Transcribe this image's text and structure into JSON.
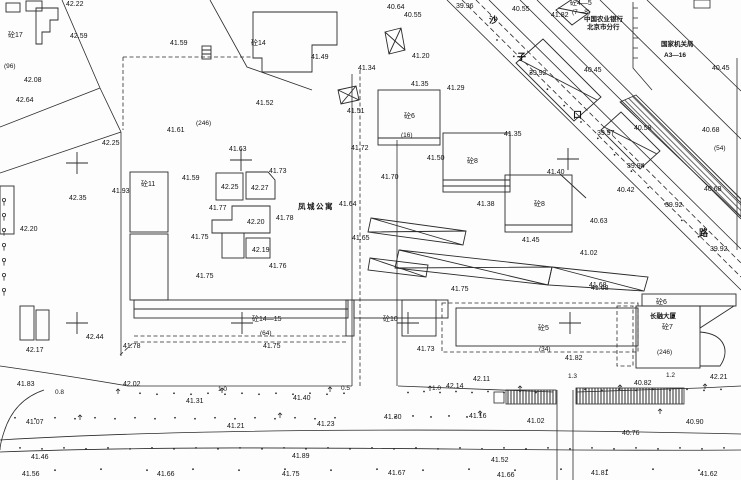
{
  "drawing": {
    "type": "topographic-site-plan",
    "street_name_chars": [
      "沙",
      "子",
      "口",
      "路"
    ],
    "place_names": {
      "apartment": "凤城公寓",
      "tower": "长融大厦",
      "bank_line1": "中国农业银行",
      "bank_line2": "北京市分行",
      "agency_line1": "国家机关局",
      "agency_line2": "A3—16"
    },
    "line_color": "#2b2b2b",
    "background": "#fdfdfd"
  },
  "labels": [
    {
      "t": "42.22",
      "x": 66,
      "y": 1,
      "k": "e"
    },
    {
      "t": "砼17",
      "x": 8,
      "y": 32,
      "k": "b"
    },
    {
      "t": "42.59",
      "x": 70,
      "y": 33,
      "k": "e"
    },
    {
      "t": "41.59",
      "x": 170,
      "y": 40,
      "k": "e"
    },
    {
      "t": "(96)",
      "x": 4,
      "y": 63,
      "k": "p"
    },
    {
      "t": "42.08",
      "x": 24,
      "y": 77,
      "k": "e"
    },
    {
      "t": "42.64",
      "x": 16,
      "y": 97,
      "k": "e"
    },
    {
      "t": "(246)",
      "x": 196,
      "y": 120,
      "k": "p"
    },
    {
      "t": "41.61",
      "x": 167,
      "y": 127,
      "k": "e"
    },
    {
      "t": "42.25",
      "x": 102,
      "y": 140,
      "k": "e"
    },
    {
      "t": "41.93",
      "x": 112,
      "y": 188,
      "k": "e"
    },
    {
      "t": "砼11",
      "x": 141,
      "y": 181,
      "k": "b"
    },
    {
      "t": "42.35",
      "x": 69,
      "y": 195,
      "k": "e"
    },
    {
      "t": "42.20",
      "x": 20,
      "y": 226,
      "k": "e"
    },
    {
      "t": "41.63",
      "x": 229,
      "y": 146,
      "k": "e"
    },
    {
      "t": "41.73",
      "x": 269,
      "y": 168,
      "k": "e"
    },
    {
      "t": "41.59",
      "x": 182,
      "y": 175,
      "k": "e"
    },
    {
      "t": "42.25",
      "x": 221,
      "y": 184,
      "k": "e"
    },
    {
      "t": "42.27",
      "x": 251,
      "y": 185,
      "k": "e"
    },
    {
      "t": "41.77",
      "x": 209,
      "y": 205,
      "k": "e"
    },
    {
      "t": "凤城公寓",
      "x": 298,
      "y": 203,
      "k": "n"
    },
    {
      "t": "42.20",
      "x": 247,
      "y": 219,
      "k": "e"
    },
    {
      "t": "41.78",
      "x": 276,
      "y": 215,
      "k": "e"
    },
    {
      "t": "41.75",
      "x": 191,
      "y": 234,
      "k": "e"
    },
    {
      "t": "42.19",
      "x": 252,
      "y": 247,
      "k": "e"
    },
    {
      "t": "41.76",
      "x": 269,
      "y": 263,
      "k": "e"
    },
    {
      "t": "41.75",
      "x": 196,
      "y": 273,
      "k": "e"
    },
    {
      "t": "42.44",
      "x": 86,
      "y": 334,
      "k": "e"
    },
    {
      "t": "42.17",
      "x": 26,
      "y": 347,
      "k": "e"
    },
    {
      "t": "41.78",
      "x": 123,
      "y": 343,
      "k": "e"
    },
    {
      "t": "41.83",
      "x": 17,
      "y": 381,
      "k": "e"
    },
    {
      "t": "42.02",
      "x": 123,
      "y": 381,
      "k": "e"
    },
    {
      "t": "0.8",
      "x": 55,
      "y": 389,
      "k": "d"
    },
    {
      "t": "砼14—15",
      "x": 252,
      "y": 316,
      "k": "b"
    },
    {
      "t": "(64)",
      "x": 260,
      "y": 330,
      "k": "p"
    },
    {
      "t": "41.75",
      "x": 263,
      "y": 343,
      "k": "e"
    },
    {
      "t": "砼10",
      "x": 383,
      "y": 316,
      "k": "b"
    },
    {
      "t": "1.0",
      "x": 218,
      "y": 386,
      "k": "d"
    },
    {
      "t": "0.5",
      "x": 341,
      "y": 385,
      "k": "d"
    },
    {
      "t": "41.40",
      "x": 293,
      "y": 395,
      "k": "e"
    },
    {
      "t": "41.31",
      "x": 186,
      "y": 398,
      "k": "e"
    },
    {
      "t": "41.07",
      "x": 26,
      "y": 419,
      "k": "e"
    },
    {
      "t": "41.21",
      "x": 227,
      "y": 423,
      "k": "e"
    },
    {
      "t": "41.46",
      "x": 31,
      "y": 454,
      "k": "e"
    },
    {
      "t": "41.56",
      "x": 22,
      "y": 471,
      "k": "e"
    },
    {
      "t": "41.66",
      "x": 157,
      "y": 471,
      "k": "e"
    },
    {
      "t": "41.30",
      "x": 384,
      "y": 414,
      "k": "e"
    },
    {
      "t": "41.16",
      "x": 469,
      "y": 413,
      "k": "e"
    },
    {
      "t": "41.23",
      "x": 317,
      "y": 421,
      "k": "e"
    },
    {
      "t": "41.89",
      "x": 292,
      "y": 453,
      "k": "e"
    },
    {
      "t": "41.75",
      "x": 282,
      "y": 471,
      "k": "e"
    },
    {
      "t": "41.67",
      "x": 388,
      "y": 470,
      "k": "e"
    },
    {
      "t": "41.02",
      "x": 527,
      "y": 418,
      "k": "e"
    },
    {
      "t": "40.90",
      "x": 686,
      "y": 419,
      "k": "e"
    },
    {
      "t": "40.76",
      "x": 622,
      "y": 430,
      "k": "e"
    },
    {
      "t": "41.52",
      "x": 491,
      "y": 457,
      "k": "e"
    },
    {
      "t": "41.66",
      "x": 497,
      "y": 472,
      "k": "e"
    },
    {
      "t": "41.81",
      "x": 591,
      "y": 470,
      "k": "e"
    },
    {
      "t": "41.62",
      "x": 700,
      "y": 471,
      "k": "e"
    },
    {
      "t": "41.75",
      "x": 451,
      "y": 286,
      "k": "e"
    },
    {
      "t": "41.68",
      "x": 591,
      "y": 285,
      "k": "e"
    },
    {
      "t": "砼5",
      "x": 538,
      "y": 325,
      "k": "b"
    },
    {
      "t": "41.73",
      "x": 417,
      "y": 346,
      "k": "e"
    },
    {
      "t": "(34)",
      "x": 539,
      "y": 346,
      "k": "p"
    },
    {
      "t": "41.82",
      "x": 565,
      "y": 355,
      "k": "e"
    },
    {
      "t": "42.11",
      "x": 473,
      "y": 376,
      "k": "e"
    },
    {
      "t": "42.14",
      "x": 446,
      "y": 383,
      "k": "e"
    },
    {
      "t": "1.0",
      "x": 432,
      "y": 385,
      "k": "d"
    },
    {
      "t": "1.3",
      "x": 568,
      "y": 373,
      "k": "d"
    },
    {
      "t": "砼6",
      "x": 656,
      "y": 299,
      "k": "b"
    },
    {
      "t": "长融大厦",
      "x": 650,
      "y": 313,
      "k": "n2"
    },
    {
      "t": "砼7",
      "x": 662,
      "y": 324,
      "k": "b"
    },
    {
      "t": "(246)",
      "x": 657,
      "y": 349,
      "k": "p"
    },
    {
      "t": "1.2",
      "x": 666,
      "y": 372,
      "k": "d"
    },
    {
      "t": "42.21",
      "x": 710,
      "y": 374,
      "k": "e"
    },
    {
      "t": "40.82",
      "x": 634,
      "y": 380,
      "k": "e"
    },
    {
      "t": "40.64",
      "x": 387,
      "y": 4,
      "k": "e"
    },
    {
      "t": "40.55",
      "x": 404,
      "y": 12,
      "k": "e"
    },
    {
      "t": "39.96",
      "x": 456,
      "y": 3,
      "k": "e"
    },
    {
      "t": "41.34",
      "x": 358,
      "y": 65,
      "k": "e"
    },
    {
      "t": "41.20",
      "x": 412,
      "y": 53,
      "k": "e"
    },
    {
      "t": "41.49",
      "x": 311,
      "y": 54,
      "k": "e"
    },
    {
      "t": "砼14",
      "x": 251,
      "y": 40,
      "k": "b"
    },
    {
      "t": "41.52",
      "x": 256,
      "y": 100,
      "k": "e"
    },
    {
      "t": "41.51",
      "x": 347,
      "y": 108,
      "k": "e"
    },
    {
      "t": "41.35",
      "x": 411,
      "y": 81,
      "k": "e"
    },
    {
      "t": "41.29",
      "x": 447,
      "y": 85,
      "k": "e"
    },
    {
      "t": "41.35",
      "x": 504,
      "y": 131,
      "k": "e"
    },
    {
      "t": "砼6",
      "x": 404,
      "y": 113,
      "k": "b"
    },
    {
      "t": "(16)",
      "x": 401,
      "y": 132,
      "k": "p"
    },
    {
      "t": "41.72",
      "x": 351,
      "y": 145,
      "k": "e"
    },
    {
      "t": "41.50",
      "x": 427,
      "y": 155,
      "k": "e"
    },
    {
      "t": "砼8",
      "x": 467,
      "y": 158,
      "k": "b"
    },
    {
      "t": "41.70",
      "x": 381,
      "y": 174,
      "k": "e"
    },
    {
      "t": "41.64",
      "x": 339,
      "y": 201,
      "k": "e"
    },
    {
      "t": "41.38",
      "x": 477,
      "y": 201,
      "k": "e"
    },
    {
      "t": "砼8",
      "x": 534,
      "y": 201,
      "k": "b"
    },
    {
      "t": "41.65",
      "x": 352,
      "y": 235,
      "k": "e"
    },
    {
      "t": "41.45",
      "x": 522,
      "y": 237,
      "k": "e"
    },
    {
      "t": "41.40",
      "x": 547,
      "y": 169,
      "k": "e"
    },
    {
      "t": "40.55",
      "x": 512,
      "y": 6,
      "k": "e"
    },
    {
      "t": "41.82",
      "x": 551,
      "y": 12,
      "k": "e"
    },
    {
      "t": "砼4—5",
      "x": 570,
      "y": 0,
      "k": "b"
    },
    {
      "t": "(7—8)",
      "x": 572,
      "y": 9,
      "k": "p"
    },
    {
      "t": "中国农业银行",
      "x": 584,
      "y": 16,
      "k": "n2"
    },
    {
      "t": "北京市分行",
      "x": 587,
      "y": 24,
      "k": "n2"
    },
    {
      "t": "沙",
      "x": 489,
      "y": 16,
      "k": "s"
    },
    {
      "t": "子",
      "x": 517,
      "y": 53,
      "k": "s"
    },
    {
      "t": "口",
      "x": 573,
      "y": 111,
      "k": "s"
    },
    {
      "t": "路",
      "x": 699,
      "y": 229,
      "k": "s"
    },
    {
      "t": "39.92",
      "x": 529,
      "y": 70,
      "k": "e"
    },
    {
      "t": "40.45",
      "x": 584,
      "y": 67,
      "k": "e"
    },
    {
      "t": "国家机关局",
      "x": 661,
      "y": 41,
      "k": "n2"
    },
    {
      "t": "A3—16",
      "x": 664,
      "y": 52,
      "k": "n2"
    },
    {
      "t": "40.45",
      "x": 712,
      "y": 65,
      "k": "e"
    },
    {
      "t": "40.68",
      "x": 702,
      "y": 127,
      "k": "e"
    },
    {
      "t": "40.58",
      "x": 634,
      "y": 125,
      "k": "e"
    },
    {
      "t": "39.97",
      "x": 597,
      "y": 130,
      "k": "e"
    },
    {
      "t": "(54)",
      "x": 714,
      "y": 145,
      "k": "p"
    },
    {
      "t": "39.94",
      "x": 627,
      "y": 163,
      "k": "e"
    },
    {
      "t": "40.68",
      "x": 704,
      "y": 186,
      "k": "e"
    },
    {
      "t": "40.42",
      "x": 617,
      "y": 187,
      "k": "e"
    },
    {
      "t": "39.92",
      "x": 665,
      "y": 202,
      "k": "e"
    },
    {
      "t": "40.63",
      "x": 590,
      "y": 218,
      "k": "e"
    },
    {
      "t": "41.02",
      "x": 580,
      "y": 250,
      "k": "e"
    },
    {
      "t": "39.92",
      "x": 710,
      "y": 246,
      "k": "e"
    },
    {
      "t": "41.68",
      "x": 589,
      "y": 282,
      "k": "e"
    }
  ],
  "crosses": [
    [
      241,
      160
    ],
    [
      77,
      163
    ],
    [
      568,
      159
    ],
    [
      77,
      323
    ],
    [
      242,
      323
    ],
    [
      408,
      323
    ],
    [
      570,
      323
    ]
  ]
}
